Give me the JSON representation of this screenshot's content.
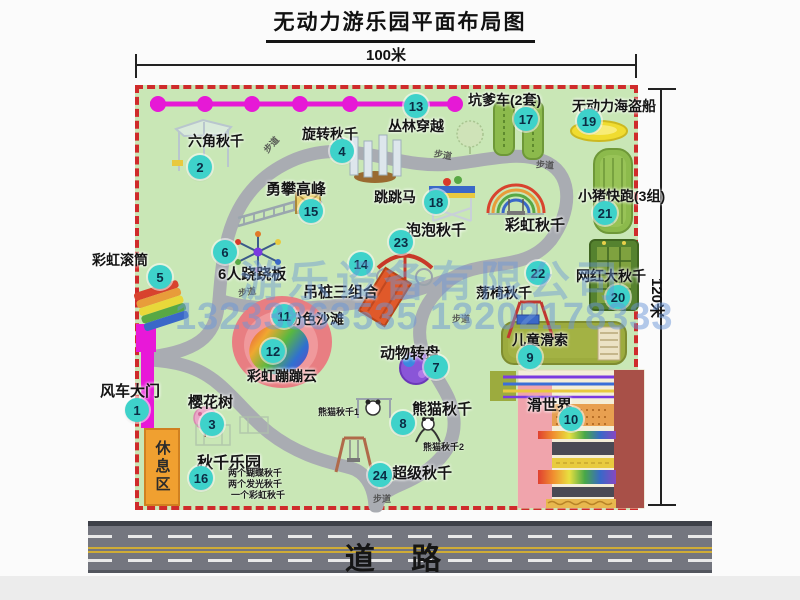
{
  "title": "无动力游乐园平面布局图",
  "dimensions": {
    "top": "100米",
    "right": "120米"
  },
  "watermark": {
    "line1": "游乐设备有限公司",
    "line2": "13233863535 13202178333"
  },
  "road": {
    "label": "道 路"
  },
  "rest_area": {
    "label": "休息区"
  },
  "colors": {
    "park_green": "#c9e7b6",
    "border_red": "#cf2b2b",
    "badge_teal": "#3ed2ca",
    "chain_magenta": "#e619d6",
    "gate_magenta": "#e818d8",
    "path_gray": "#a9acb2",
    "road_gray": "#74767f",
    "watermark_blue": "#6a96d7",
    "rest_orange": "#f0a030"
  },
  "facilities": {
    "labels": [
      {
        "text": "六角秋千",
        "x": 188,
        "y": 131,
        "s": 14
      },
      {
        "text": "旋转秋千",
        "x": 302,
        "y": 124,
        "s": 14
      },
      {
        "text": "丛林穿越",
        "x": 388,
        "y": 116,
        "s": 14
      },
      {
        "text": "坑爹车(2套)",
        "x": 468,
        "y": 90,
        "s": 14
      },
      {
        "text": "无动力海盗船",
        "x": 572,
        "y": 96,
        "s": 14
      },
      {
        "text": "勇攀高峰",
        "x": 266,
        "y": 178,
        "s": 15
      },
      {
        "text": "跳跳马",
        "x": 374,
        "y": 187,
        "s": 14
      },
      {
        "text": "小猪快跑(3组)",
        "x": 578,
        "y": 186,
        "s": 14
      },
      {
        "text": "彩虹秋千",
        "x": 505,
        "y": 214,
        "s": 15
      },
      {
        "text": "泡泡秋千",
        "x": 406,
        "y": 219,
        "s": 15
      },
      {
        "text": "彩虹滚筒",
        "x": 92,
        "y": 250,
        "s": 14
      },
      {
        "text": "6人跷跷板",
        "x": 218,
        "y": 263,
        "s": 15
      },
      {
        "text": "网红大秋千",
        "x": 576,
        "y": 266,
        "s": 14
      },
      {
        "text": "吊桩三组合",
        "x": 303,
        "y": 281,
        "s": 15
      },
      {
        "text": "荡椅秋千",
        "x": 476,
        "y": 283,
        "s": 14
      },
      {
        "text": "粉色沙滩",
        "x": 288,
        "y": 309,
        "s": 14
      },
      {
        "text": "儿童滑索",
        "x": 512,
        "y": 330,
        "s": 14
      },
      {
        "text": "动物转盘",
        "x": 380,
        "y": 342,
        "s": 15
      },
      {
        "text": "风车大门",
        "x": 100,
        "y": 380,
        "s": 15
      },
      {
        "text": "彩虹蹦蹦云",
        "x": 247,
        "y": 366,
        "s": 14
      },
      {
        "text": "滑世界",
        "x": 527,
        "y": 394,
        "s": 15
      },
      {
        "text": "樱花树",
        "x": 188,
        "y": 391,
        "s": 15
      },
      {
        "text": "熊猫秋千",
        "x": 412,
        "y": 398,
        "s": 15
      },
      {
        "text": "秋千乐园",
        "x": 197,
        "y": 449,
        "s": 16
      },
      {
        "text": "超级秋千",
        "x": 392,
        "y": 462,
        "s": 15
      }
    ],
    "sub_labels": [
      {
        "text": "熊猫秋千1",
        "x": 318,
        "y": 405
      },
      {
        "text": "熊猫秋千2",
        "x": 423,
        "y": 440
      },
      {
        "text": "两个蝴蝶秋千",
        "x": 228,
        "y": 466
      },
      {
        "text": "两个发光秋千",
        "x": 228,
        "y": 477
      },
      {
        "text": "一个彩虹秋千",
        "x": 231,
        "y": 488
      }
    ],
    "path_labels": [
      {
        "text": "步道",
        "x": 262,
        "y": 138,
        "r": -48
      },
      {
        "text": "步道",
        "x": 434,
        "y": 148,
        "r": 10
      },
      {
        "text": "步道",
        "x": 536,
        "y": 158,
        "r": 4
      },
      {
        "text": "步道",
        "x": 238,
        "y": 285,
        "r": -8
      },
      {
        "text": "步道",
        "x": 452,
        "y": 312,
        "r": 0
      },
      {
        "text": "步道",
        "x": 373,
        "y": 492,
        "r": 0
      }
    ],
    "badges": [
      {
        "n": 1,
        "x": 137,
        "y": 410
      },
      {
        "n": 2,
        "x": 200,
        "y": 167
      },
      {
        "n": 3,
        "x": 212,
        "y": 424
      },
      {
        "n": 4,
        "x": 342,
        "y": 151
      },
      {
        "n": 5,
        "x": 160,
        "y": 277
      },
      {
        "n": 6,
        "x": 225,
        "y": 252
      },
      {
        "n": 7,
        "x": 436,
        "y": 367
      },
      {
        "n": 8,
        "x": 403,
        "y": 423
      },
      {
        "n": 9,
        "x": 530,
        "y": 357
      },
      {
        "n": 10,
        "x": 571,
        "y": 419
      },
      {
        "n": 11,
        "x": 284,
        "y": 316
      },
      {
        "n": 12,
        "x": 273,
        "y": 351
      },
      {
        "n": 13,
        "x": 416,
        "y": 106
      },
      {
        "n": 14,
        "x": 361,
        "y": 264
      },
      {
        "n": 15,
        "x": 311,
        "y": 211
      },
      {
        "n": 16,
        "x": 201,
        "y": 478
      },
      {
        "n": 17,
        "x": 526,
        "y": 119
      },
      {
        "n": 18,
        "x": 436,
        "y": 202
      },
      {
        "n": 19,
        "x": 589,
        "y": 121
      },
      {
        "n": 20,
        "x": 618,
        "y": 297
      },
      {
        "n": 21,
        "x": 605,
        "y": 213
      },
      {
        "n": 22,
        "x": 538,
        "y": 273
      },
      {
        "n": 23,
        "x": 401,
        "y": 242
      },
      {
        "n": 24,
        "x": 380,
        "y": 475
      }
    ]
  }
}
